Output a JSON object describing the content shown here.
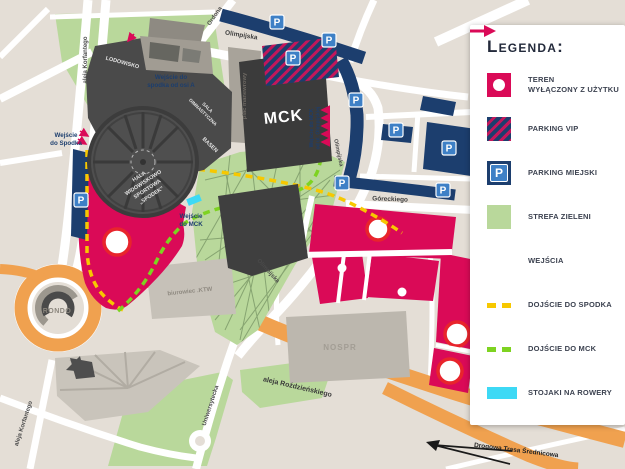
{
  "colors": {
    "crimson": "#DA0A57",
    "navy": "#1C3E6E",
    "parking_blue": "#3E80C6",
    "green": "#B9D89B",
    "orange": "#F0A14F",
    "yellow": "#F7C800",
    "lime": "#7ED321",
    "cyan": "#3DD9F5",
    "dark_building": "#4A4A4A",
    "background": "#E4DED6",
    "ring_red": "#E8242C"
  },
  "legend": {
    "title": "Legenda:",
    "items": [
      {
        "line1": "TEREN",
        "line2": "WYŁĄCZONY Z UŻYTKU"
      },
      {
        "label": "PARKING VIP"
      },
      {
        "label": "PARKING MIEJSKI"
      },
      {
        "label": "STREFA ZIELENI"
      },
      {
        "label": "WEJŚCIA"
      },
      {
        "label": "DOJŚCIE DO SPODKA"
      },
      {
        "label": "DOJŚCIE DO MCK"
      },
      {
        "label": "STOJAKI NA ROWERY"
      }
    ]
  },
  "map": {
    "parking_letter": "P",
    "streets": {
      "korfantego": "aleja Korfantego",
      "ordona": "Ordona",
      "olimpijska": "Olimpijska",
      "goreckiego": "Góreckiego",
      "uniwersytecka": "Uniwersytecka",
      "rozdzienskiego": "aleja Roździeńskiego",
      "dts": "Drogowa Trasa Średnicowa"
    },
    "places": {
      "mck": "MCK",
      "nospr": "NOSPR",
      "ktw": "biurowiec .KTW",
      "rondo": "RONDO",
      "lodowisko": "LODOWISKO",
      "basen": "BASEN",
      "sala1": "SALA",
      "sala2": "GIMNASTYCZNA",
      "plac": "plac manewrowy",
      "hala1": "HALA",
      "hala2": "WIDOWISKOWO",
      "hala3": "SPORTOWA",
      "hala4": "„SPODEK”"
    },
    "entrances": {
      "spodek_w1": "Wejście",
      "spodek_w2": "do Spodka",
      "osi_a1": "Wejście do",
      "osi_a2": "spodka od osi A",
      "mck1": "Wejście",
      "mck2": "do MCK",
      "mck_ol1": "Wejście do MCK",
      "mck_ol2": "od ul. Olimpijskiej"
    }
  }
}
